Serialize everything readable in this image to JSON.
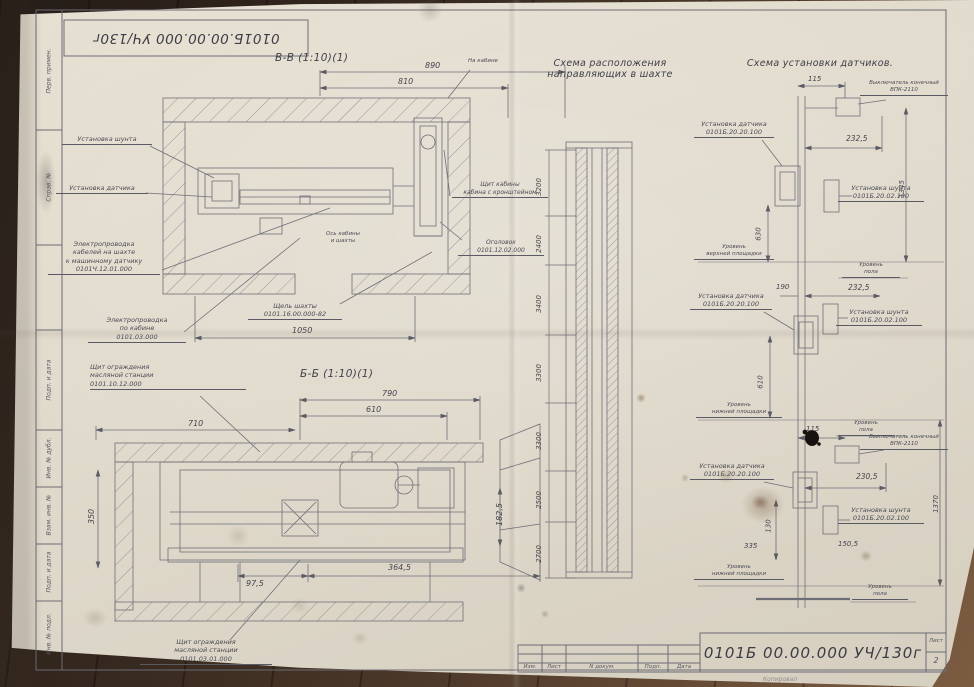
{
  "top_stamp": {
    "number": "0101Б.00.00.000 УЧ/130г"
  },
  "margin": {
    "labels": [
      "Перв. примен.",
      "Справ. №",
      "Подп. и дата",
      "Инв. № дубл.",
      "Взам. инв. №",
      "Подп. и дата",
      "Инв. № подл."
    ]
  },
  "vv": {
    "title": "В-В (1:10)(1)",
    "dim_top_outer": "890",
    "dim_top_inner": "810",
    "dim_bottom": "1050",
    "note_top_right": "На кабине",
    "shunt": "Установка шунта",
    "sensor": "Установка датчика",
    "wiring_shaft": [
      "Электропроводка",
      "кабелей на шахте",
      "к машинному датчику",
      "0101Ч.12.01.000"
    ],
    "wiring_cab": [
      "Электропроводка",
      "по кабине",
      "0101.03.000"
    ],
    "axis": [
      "Ось кабины",
      "и шахты"
    ],
    "gap": [
      "Щель шахты",
      "0101.16.00.000-82"
    ],
    "cab_shield": [
      "Щит кабины",
      "кабина с кронштейном"
    ],
    "head": [
      "Оголовок",
      "0101.12.02.000"
    ]
  },
  "bb": {
    "title": "Б-Б (1:10)(1)",
    "dim_710": "710",
    "dim_790": "790",
    "dim_610": "610",
    "dim_350": "350",
    "dim_97": "97,5",
    "dim_364": "364,5",
    "dim_182": "182,5",
    "shield_top": [
      "Щит ограждения",
      "масляной станции",
      "0101.10.12.000"
    ],
    "shield_bottom": [
      "Щит ограждения",
      "масляной станции",
      "0101.03.01.000"
    ]
  },
  "shaft": {
    "title": [
      "Схема расположения",
      "направляющих в шахте"
    ],
    "dims": [
      "3200",
      "2400",
      "3400",
      "3300",
      "3300",
      "2500",
      "2700"
    ]
  },
  "sensors": {
    "title": "Схема установки датчиков.",
    "sensor_label": [
      "Установка датчика",
      "0101Б.20.20.100"
    ],
    "shunt_label": [
      "Установка шунта",
      "0101Б.20.02.100"
    ],
    "switch_label": [
      "Выключатель конечный",
      "ВПК-2110"
    ],
    "level_top": [
      "Уровень",
      "верхней площадки"
    ],
    "level_bottom": [
      "Уровень",
      "нижней площадки"
    ],
    "level_floor": [
      "Уровень",
      "пола"
    ],
    "d115": "115",
    "d2325": "232,5",
    "d190": "190",
    "d630": "630",
    "d610": "610",
    "d1345": "1345",
    "d2305": "230,5",
    "d1505": "150,5",
    "d335": "335",
    "d130": "130",
    "d1370": "1370"
  },
  "titleblock": {
    "number": "0101Б 00.00.000 УЧ/130г",
    "sheet_word": "Лист",
    "sheet_num": "2",
    "cols": [
      "Изм.",
      "Лист",
      "N докум.",
      "Подп.",
      "Дата"
    ],
    "copied": "Копировал"
  }
}
